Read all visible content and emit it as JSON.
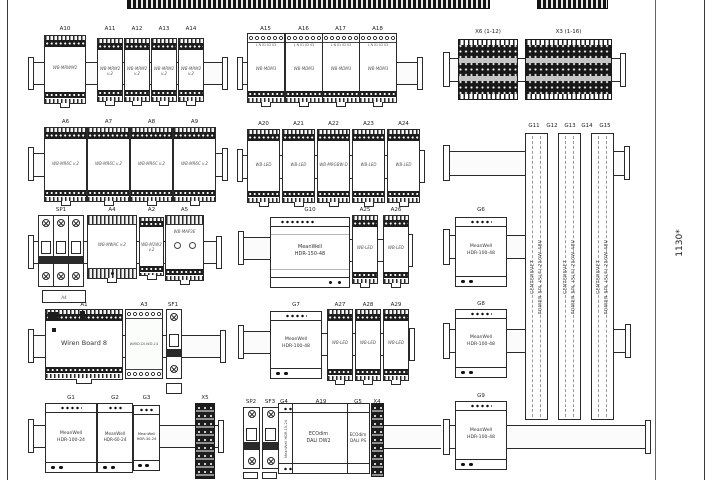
{
  "frame": {
    "dimension_label": "1130*"
  },
  "terminal_strips": {
    "x6_label": "X6 (1-12)",
    "x3_label": "X3 (1-16)",
    "x5_label": "X5",
    "x4_label": "X4"
  },
  "power_profiles": {
    "labels": [
      "G11",
      "G12",
      "G13",
      "G14",
      "G15"
    ],
    "text_line1": "CENTERSVET",
    "text_line2": "POWER SPL (SLF) 250W 48V"
  },
  "row1": {
    "a10": {
      "ref": "A10",
      "model": "WB-MRWM2"
    },
    "minis": [
      {
        "ref": "A11",
        "model": "WB-MRM2 v.2"
      },
      {
        "ref": "A12",
        "model": "WB-MRM2 v.2"
      },
      {
        "ref": "A13",
        "model": "WB-MRM2 v.2"
      },
      {
        "ref": "A14",
        "model": "WB-MRM2 v.2"
      }
    ],
    "dimmers": [
      {
        "ref": "A15",
        "model": "WB-MDM3",
        "terminals": "L N 01 02 03"
      },
      {
        "ref": "A16",
        "model": "WB-MDM3",
        "terminals": "L N 01 02 03"
      },
      {
        "ref": "A17",
        "model": "WB-MDM3",
        "terminals": "L N 01 02 03"
      },
      {
        "ref": "A18",
        "model": "WB-MDM3",
        "terminals": "L N 01 02 03"
      }
    ]
  },
  "row2": {
    "relays": [
      {
        "ref": "A6",
        "model": "WB-MR6C v.2"
      },
      {
        "ref": "A7",
        "model": "WB-MR6C v.2"
      },
      {
        "ref": "A8",
        "model": "WB-MR6C v.2"
      },
      {
        "ref": "A9",
        "model": "WB-MR6C v.2"
      }
    ],
    "leds": [
      {
        "ref": "A20",
        "model": "WB-LED"
      },
      {
        "ref": "A21",
        "model": "WB-LED"
      },
      {
        "ref": "A22",
        "model": "WB-MRGBW-D"
      },
      {
        "ref": "A23",
        "model": "WB-LED"
      },
      {
        "ref": "A24",
        "model": "WB-LED"
      }
    ]
  },
  "row3": {
    "sp1": {
      "ref": "SP1"
    },
    "note": {
      "text": "A4"
    },
    "a4": {
      "ref": "A4",
      "model": "WB-MWAC v.2"
    },
    "a2": {
      "ref": "A2",
      "model": "WB-M1W2 v.2"
    },
    "a5": {
      "ref": "A5",
      "model": "WB-MAP3E"
    },
    "g10": {
      "ref": "G10",
      "brand": "MeanWell",
      "model": "HDR-150-48"
    },
    "leds": [
      {
        "ref": "A25",
        "model": "WB-LED"
      },
      {
        "ref": "A26",
        "model": "WB-LED"
      }
    ],
    "g6": {
      "ref": "G6",
      "brand": "MeanWell",
      "model": "HDR-100-48"
    }
  },
  "row4": {
    "a1": {
      "ref": "A1",
      "model": "Wiren Board 8"
    },
    "a3": {
      "ref": "A3",
      "model": "WBIO-DI-WD-14"
    },
    "sf1": {
      "ref": "SF1"
    },
    "g7": {
      "ref": "G7",
      "brand": "MeanWell",
      "model": "HDR-100-48"
    },
    "leds": [
      {
        "ref": "A27",
        "model": "WB-LED"
      },
      {
        "ref": "A28",
        "model": "WB-LED"
      },
      {
        "ref": "A29",
        "model": "WB-LED"
      }
    ],
    "g8": {
      "ref": "G8",
      "brand": "MeanWell",
      "model": "HDR-100-48"
    }
  },
  "row5": {
    "psus": [
      {
        "ref": "G1",
        "brand": "MeanWell",
        "model": "HDR-100-24"
      },
      {
        "ref": "G2",
        "brand": "MeanWell",
        "model": "HDR-60-24"
      },
      {
        "ref": "G3",
        "brand": "MeanWell",
        "model": "HDR-30-24"
      }
    ],
    "sp2": {
      "ref": "SP2"
    },
    "sf3": {
      "ref": "SF3"
    },
    "g4": {
      "ref": "G4",
      "model": "MeanWell HDR-15-24"
    },
    "a19": {
      "ref": "A19",
      "brand": "ECOdim",
      "model": "DALI DW2"
    },
    "g5": {
      "ref": "G5",
      "brand": "ECOdim",
      "model": "DALI PS"
    },
    "g9": {
      "ref": "G9",
      "brand": "MeanWell",
      "model": "HDR-100-48"
    }
  }
}
